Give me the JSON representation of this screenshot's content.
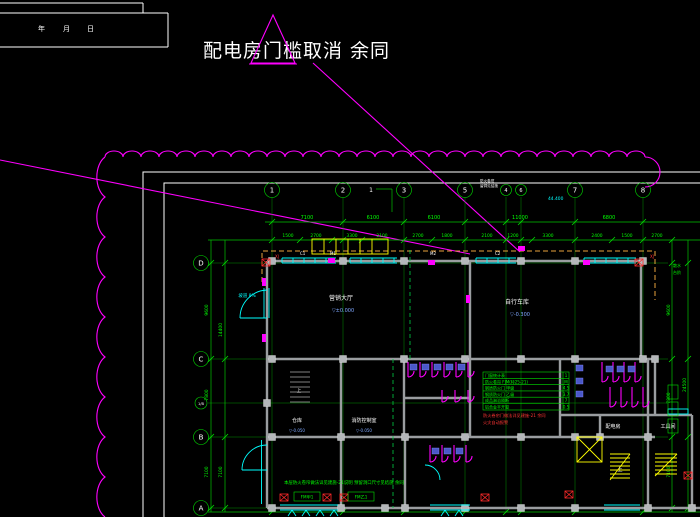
{
  "annotation": {
    "text": "配电房门槛取消 余同"
  },
  "title_block": {
    "f1": "年",
    "f2": "月",
    "f3": "日"
  },
  "grid": {
    "b1": "1",
    "b2": "2",
    "b3": "3",
    "b5": "5",
    "b4": "4",
    "b6": "6",
    "b7": "7",
    "b8": "8",
    "lD": "D",
    "lC": "C",
    "lCB": "1/B",
    "lB": "B",
    "lA": "A",
    "detail": "1"
  },
  "dims": {
    "r1": [
      "7100",
      "6100",
      "6100",
      "11000",
      "6800"
    ],
    "r2": [
      "1500",
      "2700",
      "3300",
      "2100",
      "2700",
      "1800",
      "2100",
      "1200",
      "3300",
      "2400",
      "1500",
      "2700"
    ],
    "left": [
      "9600",
      "7800",
      "7100"
    ],
    "left2": [
      "14400",
      "7100"
    ],
    "right": [
      "9600",
      "7800",
      "7100"
    ],
    "right2": [
      "24500"
    ],
    "total": "44.400"
  },
  "rooms": {
    "hall": "营销大厅",
    "hall_lv": "▽±0.000",
    "bike": "自行车库",
    "bike_lv": "▽-0.300",
    "store": "仓库",
    "store_lv": "▽-0.050",
    "fire": "消防控制室",
    "fire_lv": "▽-0.050",
    "power": "配电房",
    "tools": "工具间",
    "up1": "上",
    "up2": "上",
    "ramp": "坡道 8%"
  },
  "tags": {
    "m1": "M1",
    "m2": "M2",
    "c1": "C1",
    "c2": "C2",
    "fm1": "FM甲1",
    "fm2": "FM乙1",
    "shutter_a": "防火卷帘",
    "shutter_b": "留洞见结施",
    "xj1": "XJ",
    "xj2": "XJ"
  },
  "schedule": {
    "rows": [
      {
        "n": "门窗统计表",
        "v": "1"
      },
      {
        "n": "防火卷帘 FJM(特25-21)",
        "v": "M"
      },
      {
        "n": "钢质防火门 甲级",
        "v": "4.5"
      },
      {
        "n": "钢质防火门 乙级",
        "v": "3.7"
      },
      {
        "n": "成品淋浴隔断",
        "v": "7"
      },
      {
        "n": "铝合金平开窗",
        "v": "0.5"
      }
    ],
    "red1": "防火卷帘门做法详见建施-21 余同",
    "red2": "火灾自动报警"
  },
  "notes": {
    "bottom": "本层防火卷帘做法详见建施-21说明 预留洞口尺寸见结施 余同",
    "right1": "散水",
    "right2": "台阶"
  },
  "palette": {
    "background": "#000000",
    "grid_green": "#00c400",
    "wall_gray": "#9a9da0",
    "window_cyan": "#00ffff",
    "revision_magenta": "#ff00ff",
    "canopy_orange": "#e8a23c",
    "stair_yellow": "#ffff00",
    "alarm_red": "#ff2a2a",
    "text_white": "#ffffff",
    "level_blue": "#7fa8ff"
  }
}
